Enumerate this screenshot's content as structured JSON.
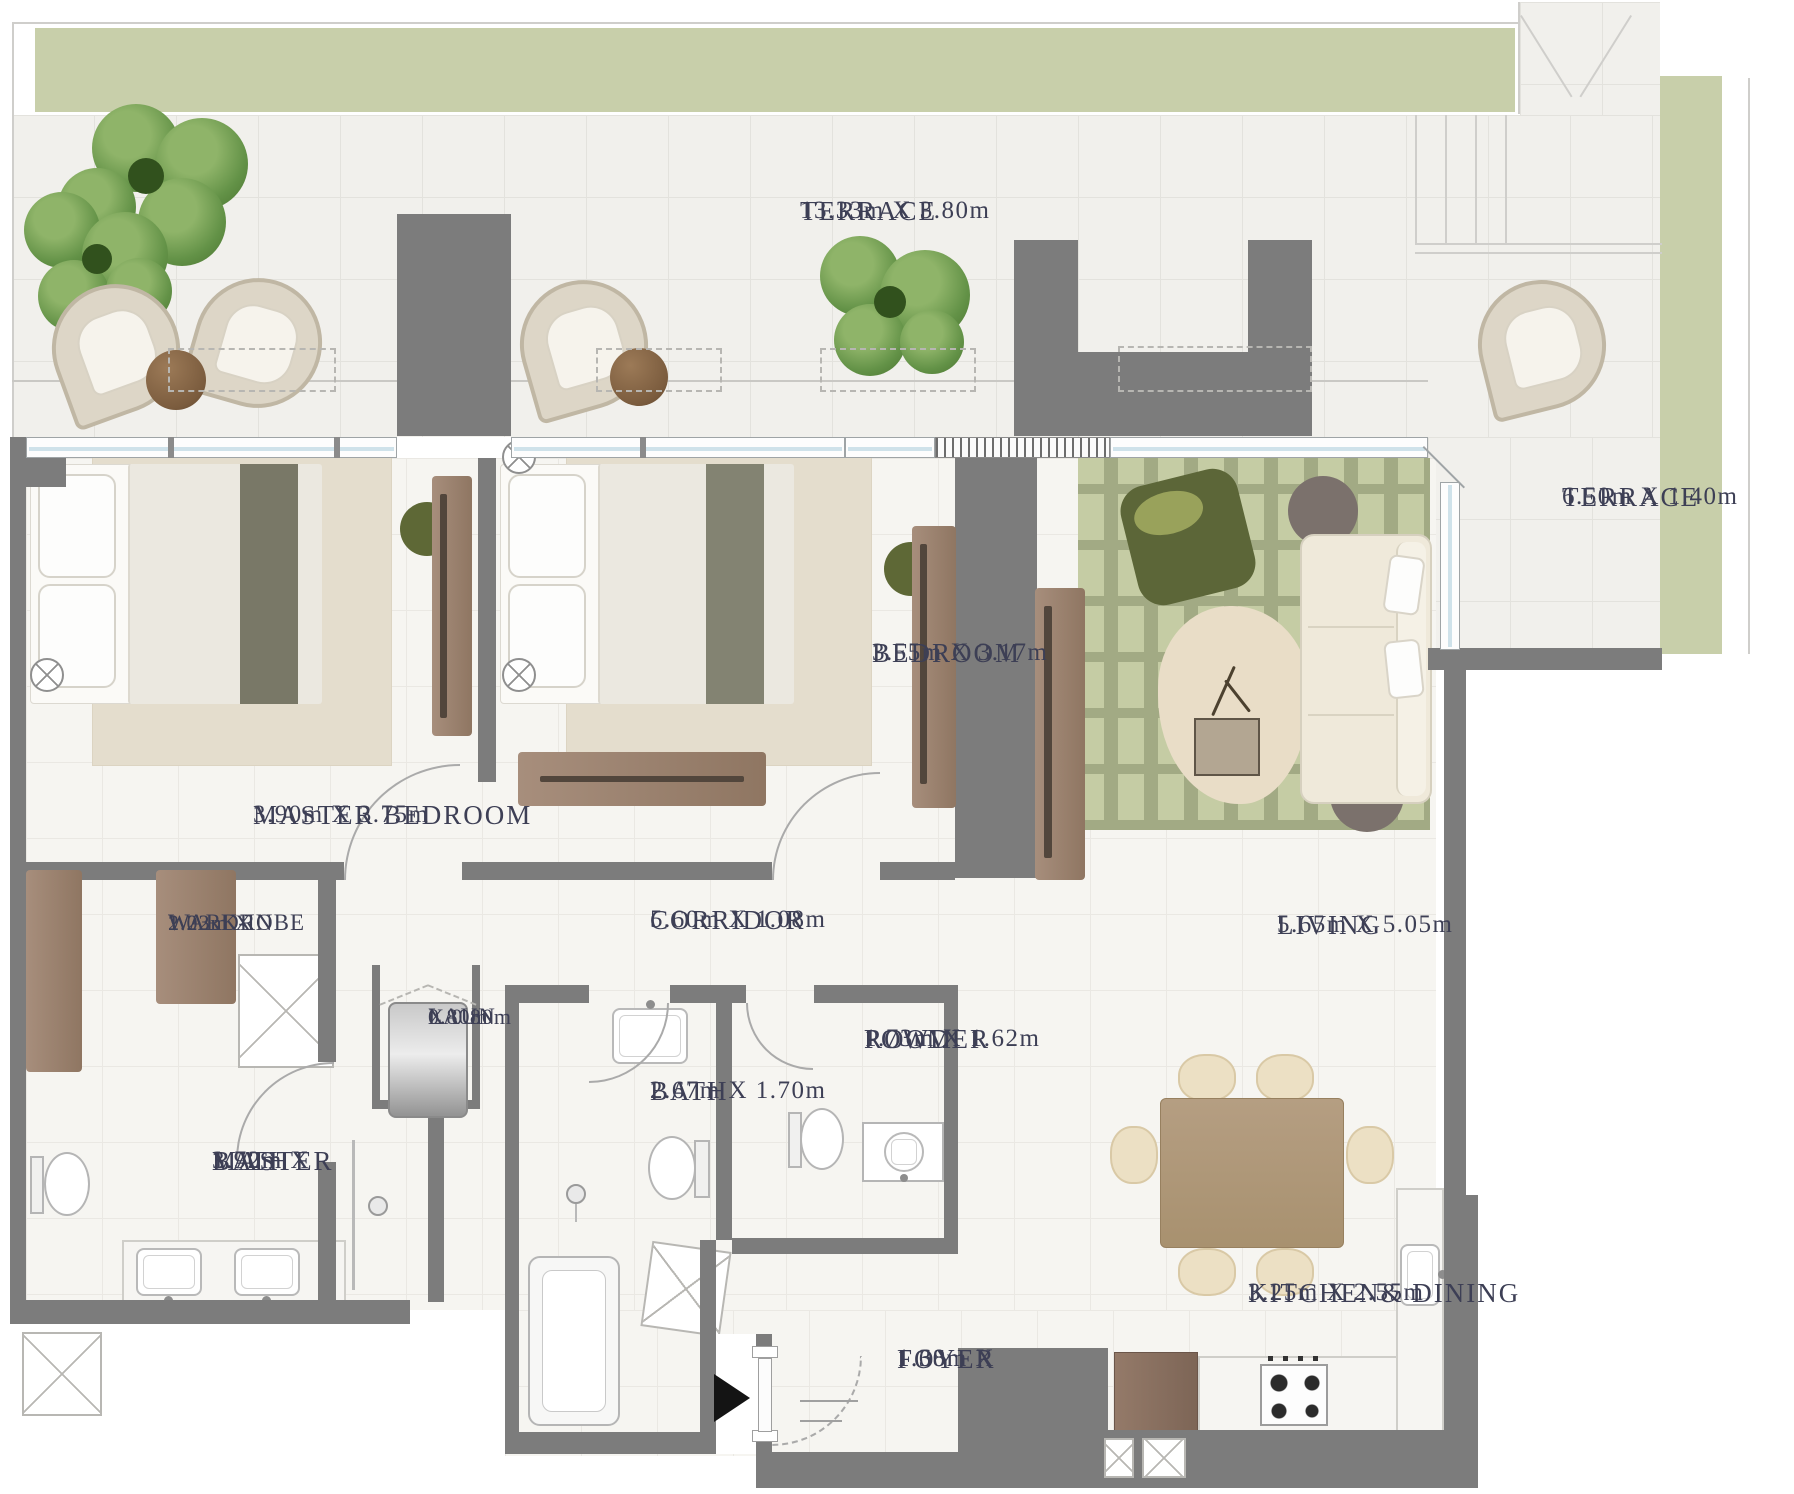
{
  "rooms": {
    "terrace_main": {
      "lines": [
        "TERRACE",
        "13.33m X 3.80m"
      ]
    },
    "terrace_side": {
      "lines": [
        "TERRACE",
        "6.50m X 1.40m"
      ]
    },
    "master_bedroom": {
      "lines": [
        "MASTER BEDROOM",
        "3.90m X 3.75m"
      ]
    },
    "bedroom": {
      "lines": [
        "BEDROOM",
        "3.55m X 3.17m"
      ]
    },
    "walk_in_wardrobe": {
      "lines": [
        "WALK-IN",
        "WARDROBE",
        "2.03m X",
        "1.22m"
      ]
    },
    "corridor": {
      "lines": [
        "CORRIDOR",
        "5.60m X 1.08m"
      ]
    },
    "laundry": {
      "lines": [
        "LAUN",
        "0.80m",
        "X 0.80m"
      ]
    },
    "bath": {
      "lines": [
        "BATH",
        "2.67m X 1.70m"
      ]
    },
    "powder_room": {
      "lines": [
        "POWDER",
        "ROOM",
        "1.73m X 1.62m"
      ]
    },
    "master_bath": {
      "lines": [
        "MASTER",
        "BATH",
        "3.90m X",
        "1.72m"
      ]
    },
    "living": {
      "lines": [
        "LIVING",
        "5.65m X 5.05m"
      ]
    },
    "kitchen_dining": {
      "lines": [
        "KITCHEN& DINING",
        "3.25m X 2.55m"
      ]
    },
    "foyer": {
      "lines": [
        "FOYER",
        "1.68m X",
        "1.30m"
      ]
    }
  },
  "entrance": {
    "icon": "entrance-arrow",
    "direction": "right"
  },
  "colors": {
    "wall": "#7c7c7c",
    "terrace_band": "#c8cfaa",
    "living_rug": "#a2aa84",
    "wood_furniture": "#9d8675",
    "label_text": "#3d3f55",
    "window_glass": "#cfe2ea"
  }
}
